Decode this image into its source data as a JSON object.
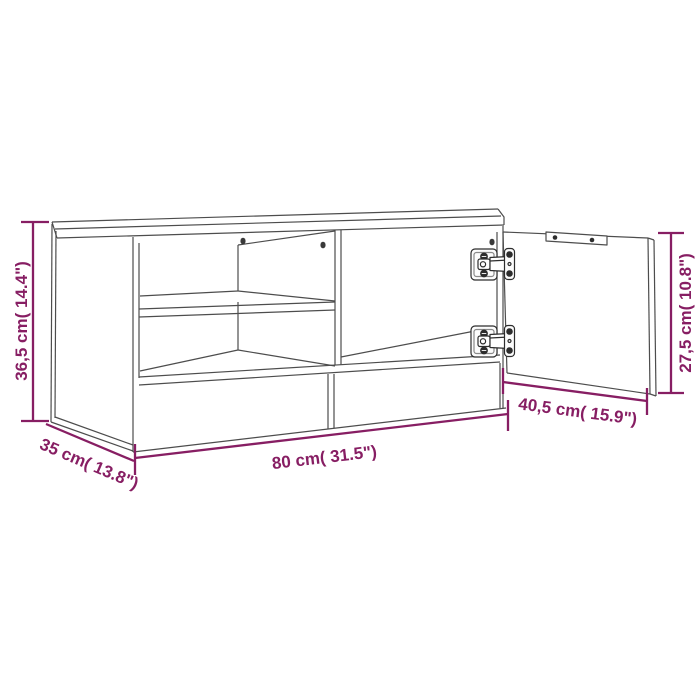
{
  "colors": {
    "accent": "#871e63",
    "line": "#4d4d4d",
    "hinge": "#2d2d2d",
    "background": "#ffffff"
  },
  "dimensions": {
    "height": {
      "label": "36,5 cm( 14.4\")",
      "cm": "36,5",
      "inch": "14.4"
    },
    "width": {
      "label": "80 cm( 31.5\")",
      "cm": "80",
      "inch": "31.5"
    },
    "depth": {
      "label": "35 cm( 13.8\")",
      "cm": "35",
      "inch": "13.8"
    },
    "door_width": {
      "label": "40,5 cm( 15.9\")",
      "cm": "40,5",
      "inch": "15.9"
    },
    "door_height": {
      "label": "27,5 cm( 10.8\")",
      "cm": "27,5",
      "inch": "10.8"
    }
  }
}
